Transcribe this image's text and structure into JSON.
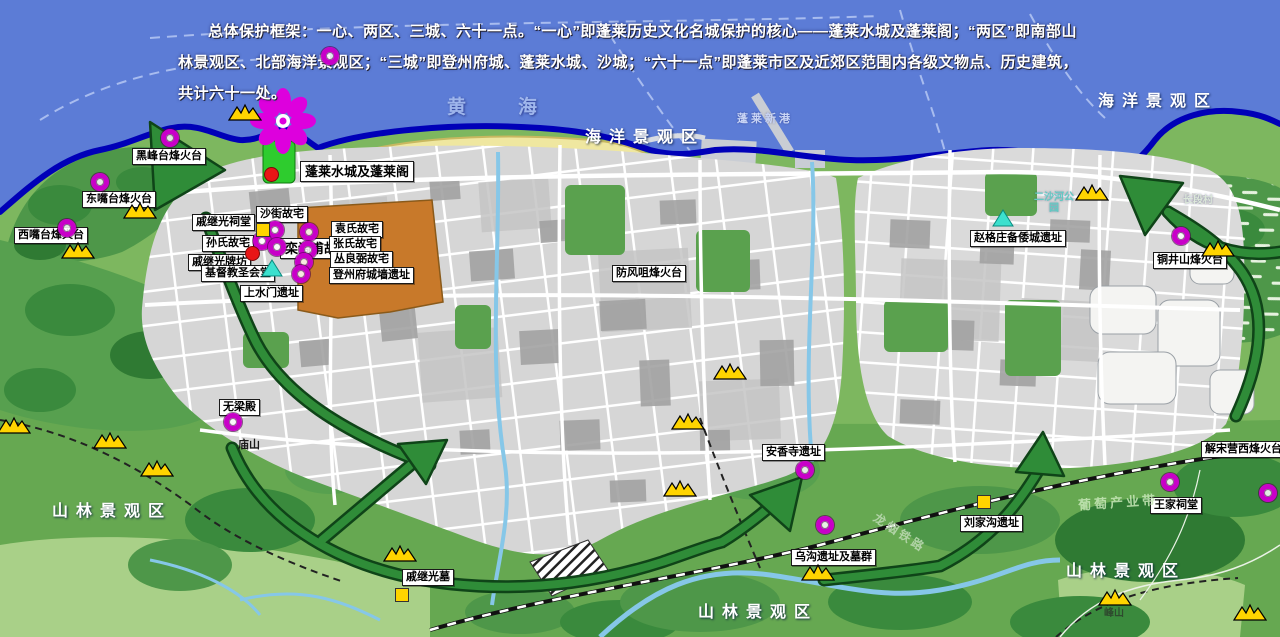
{
  "overview_text": "总体保护框架：一心、两区、三城、六十一点。“一心”即蓬莱历史文化名城保护的核心——蓬莱水城及蓬莱阁；“两区”即南部山林景观区、北部海洋景观区；“三城”即登州府城、蓬莱水城、沙城；“六十一点”即蓬莱市区及近郊区范围内各级文物点、历史建筑，共计六十一处。",
  "zones": {
    "yellow_sea": "黄海",
    "marine": "海洋景观区",
    "forest": "山林景观区",
    "new_port": "蓬莱新港"
  },
  "sites": [
    "黑峰台烽火台",
    "东嘴台烽火台",
    "西嘴台烽火台",
    "蓬莱水城及蓬莱阁",
    "沙街故宅",
    "戚继光祠堂",
    "孙氏故宅",
    "戚继光牌坊",
    "栾调甫故宅",
    "袁氏故宅",
    "张氏故宅",
    "丛良弼故宅",
    "登州府城墙遗址",
    "基督教圣会堂",
    "上水门遗址",
    "防风咀烽火台",
    "赵格庄备倭城遗址",
    "铜井山烽火台",
    "解宋营西烽火台",
    "王家祠堂",
    "刘家沟遗址",
    "安香寺遗址",
    "乌沟遗址及墓群",
    "无梁殿",
    "戚继光墓"
  ],
  "minor_labels": {
    "miaoshan": "庙山",
    "fengshan": "峰山",
    "changduancun": "长段村",
    "ershahe_park": "二沙河公园",
    "industry_belt": "葡萄产业带",
    "railway": "龙烟铁路"
  },
  "colors": {
    "sea": "#5C7CD6",
    "coastline": "#0000B8",
    "land_green": "#7DB75F",
    "urban_gray": "#D6D6D6",
    "old_city_orange": "#C8792A",
    "beach_yellow": "#EFE7A0",
    "arrow_green": "#2F8C38",
    "heritage_ring_magenta": "#C800C8",
    "core_flower_magenta": "#DD00DD",
    "mountain_gold": "#FFD400",
    "triangle_cyan": "#3CE0CE",
    "red_dot": "#E81616",
    "yellow_square": "#FFD400"
  }
}
